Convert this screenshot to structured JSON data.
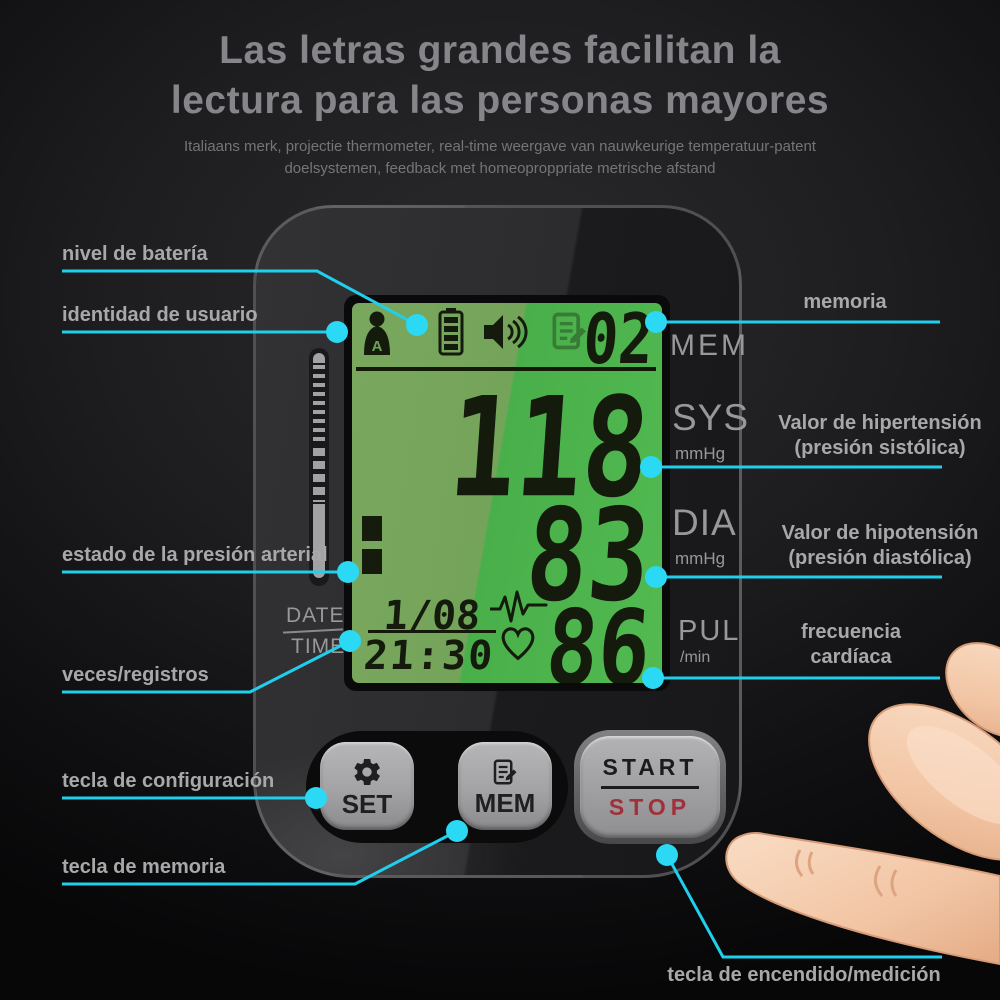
{
  "title": {
    "line1": "Las letras grandes facilitan la",
    "line2": "lectura para las personas mayores"
  },
  "subtitle": {
    "line1": "Italiaans merk, projectie thermometer, real-time weergave van nauwkeurige temperatuur-patent",
    "line2": "doelsystemen, feedback met homeoproppriate metrische afstand"
  },
  "callouts": {
    "battery_level": "nivel de batería",
    "user_identity": "identidad de usuario",
    "memory": "memoria",
    "systolic_line1": "Valor de hipertensión",
    "systolic_line2": "(presión sistólica)",
    "bp_status": "estado de la presión arterial",
    "diastolic_line1": "Valor de hipotensión",
    "diastolic_line2": "(presión diastólica)",
    "heart_rate_line1": "frecuencia",
    "heart_rate_line2": "cardíaca",
    "records": "veces/registros",
    "set_key": "tecla de configuración",
    "memory_key": "tecla de memoria",
    "power_key": "tecla de encendido/medición"
  },
  "display": {
    "memory_value": "02",
    "memory_unit": "MEM",
    "systolic_value": "118",
    "systolic_label": "SYS",
    "systolic_unit": "mmHg",
    "diastolic_value": "83",
    "diastolic_label": "DIA",
    "diastolic_unit": "mmHg",
    "pulse_value": "86",
    "pulse_label": "PUL",
    "pulse_unit": "/min",
    "date_label": "DATE",
    "time_label": "TIME",
    "date_value": "1/08",
    "time_value": "21:30",
    "user_icon_letter": "A"
  },
  "buttons": {
    "set": "SET",
    "mem": "MEM",
    "start": "START",
    "stop": "STOP"
  },
  "colors": {
    "accent_cyan": "#20cfec",
    "dot_cyan": "#2bd9f4",
    "lcd_green_dark": "#74a45a",
    "lcd_green_bright": "#4fb84f",
    "stop_red": "#a1303a"
  }
}
